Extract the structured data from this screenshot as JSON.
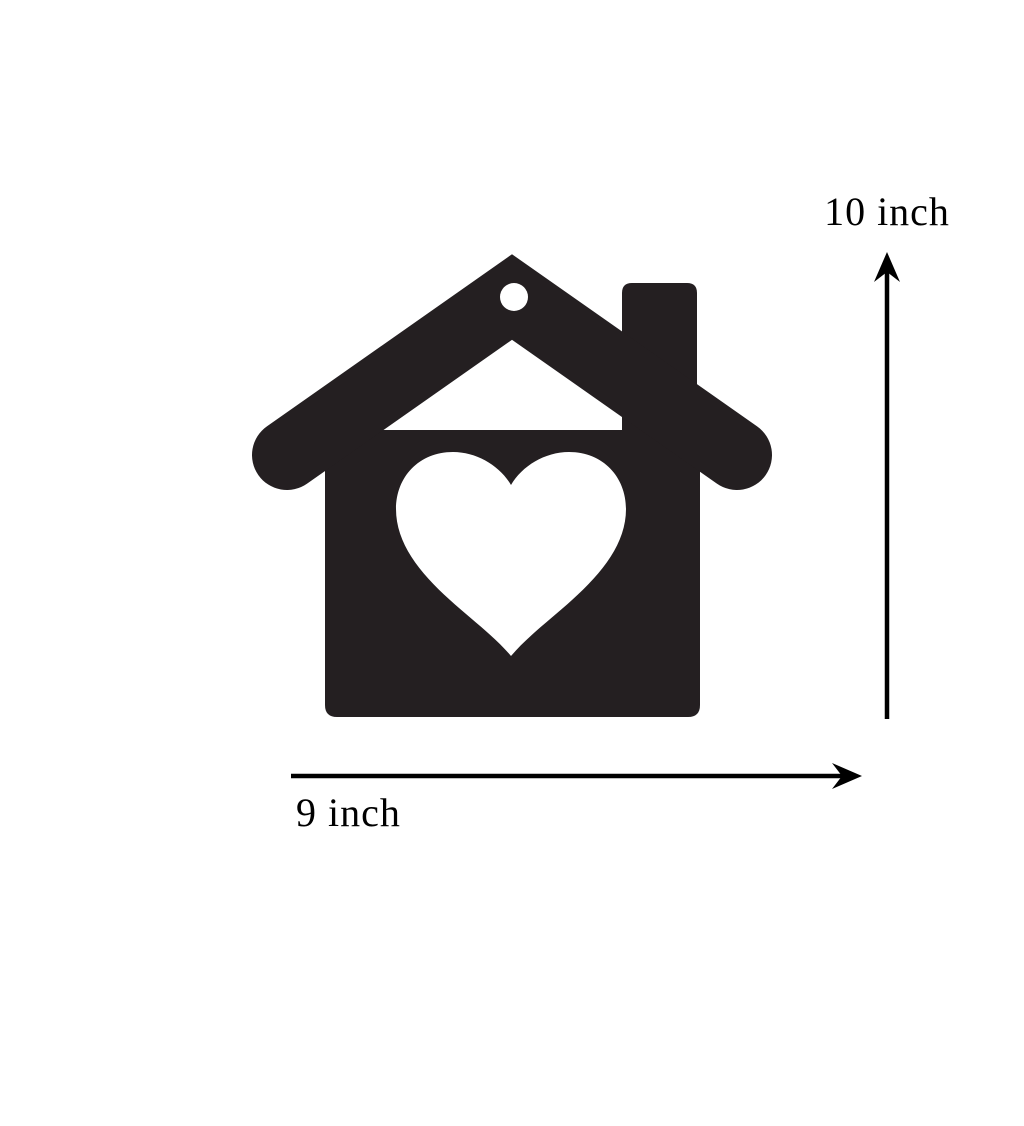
{
  "canvas": {
    "background": "#ffffff"
  },
  "figure": {
    "name": "house-with-heart-cutout-ornament",
    "color": "#241f21",
    "cutout_color": "#ffffff"
  },
  "dimensions": {
    "height_label": "10 inch",
    "width_label": "9 inch",
    "annotation_color": "#000000"
  }
}
